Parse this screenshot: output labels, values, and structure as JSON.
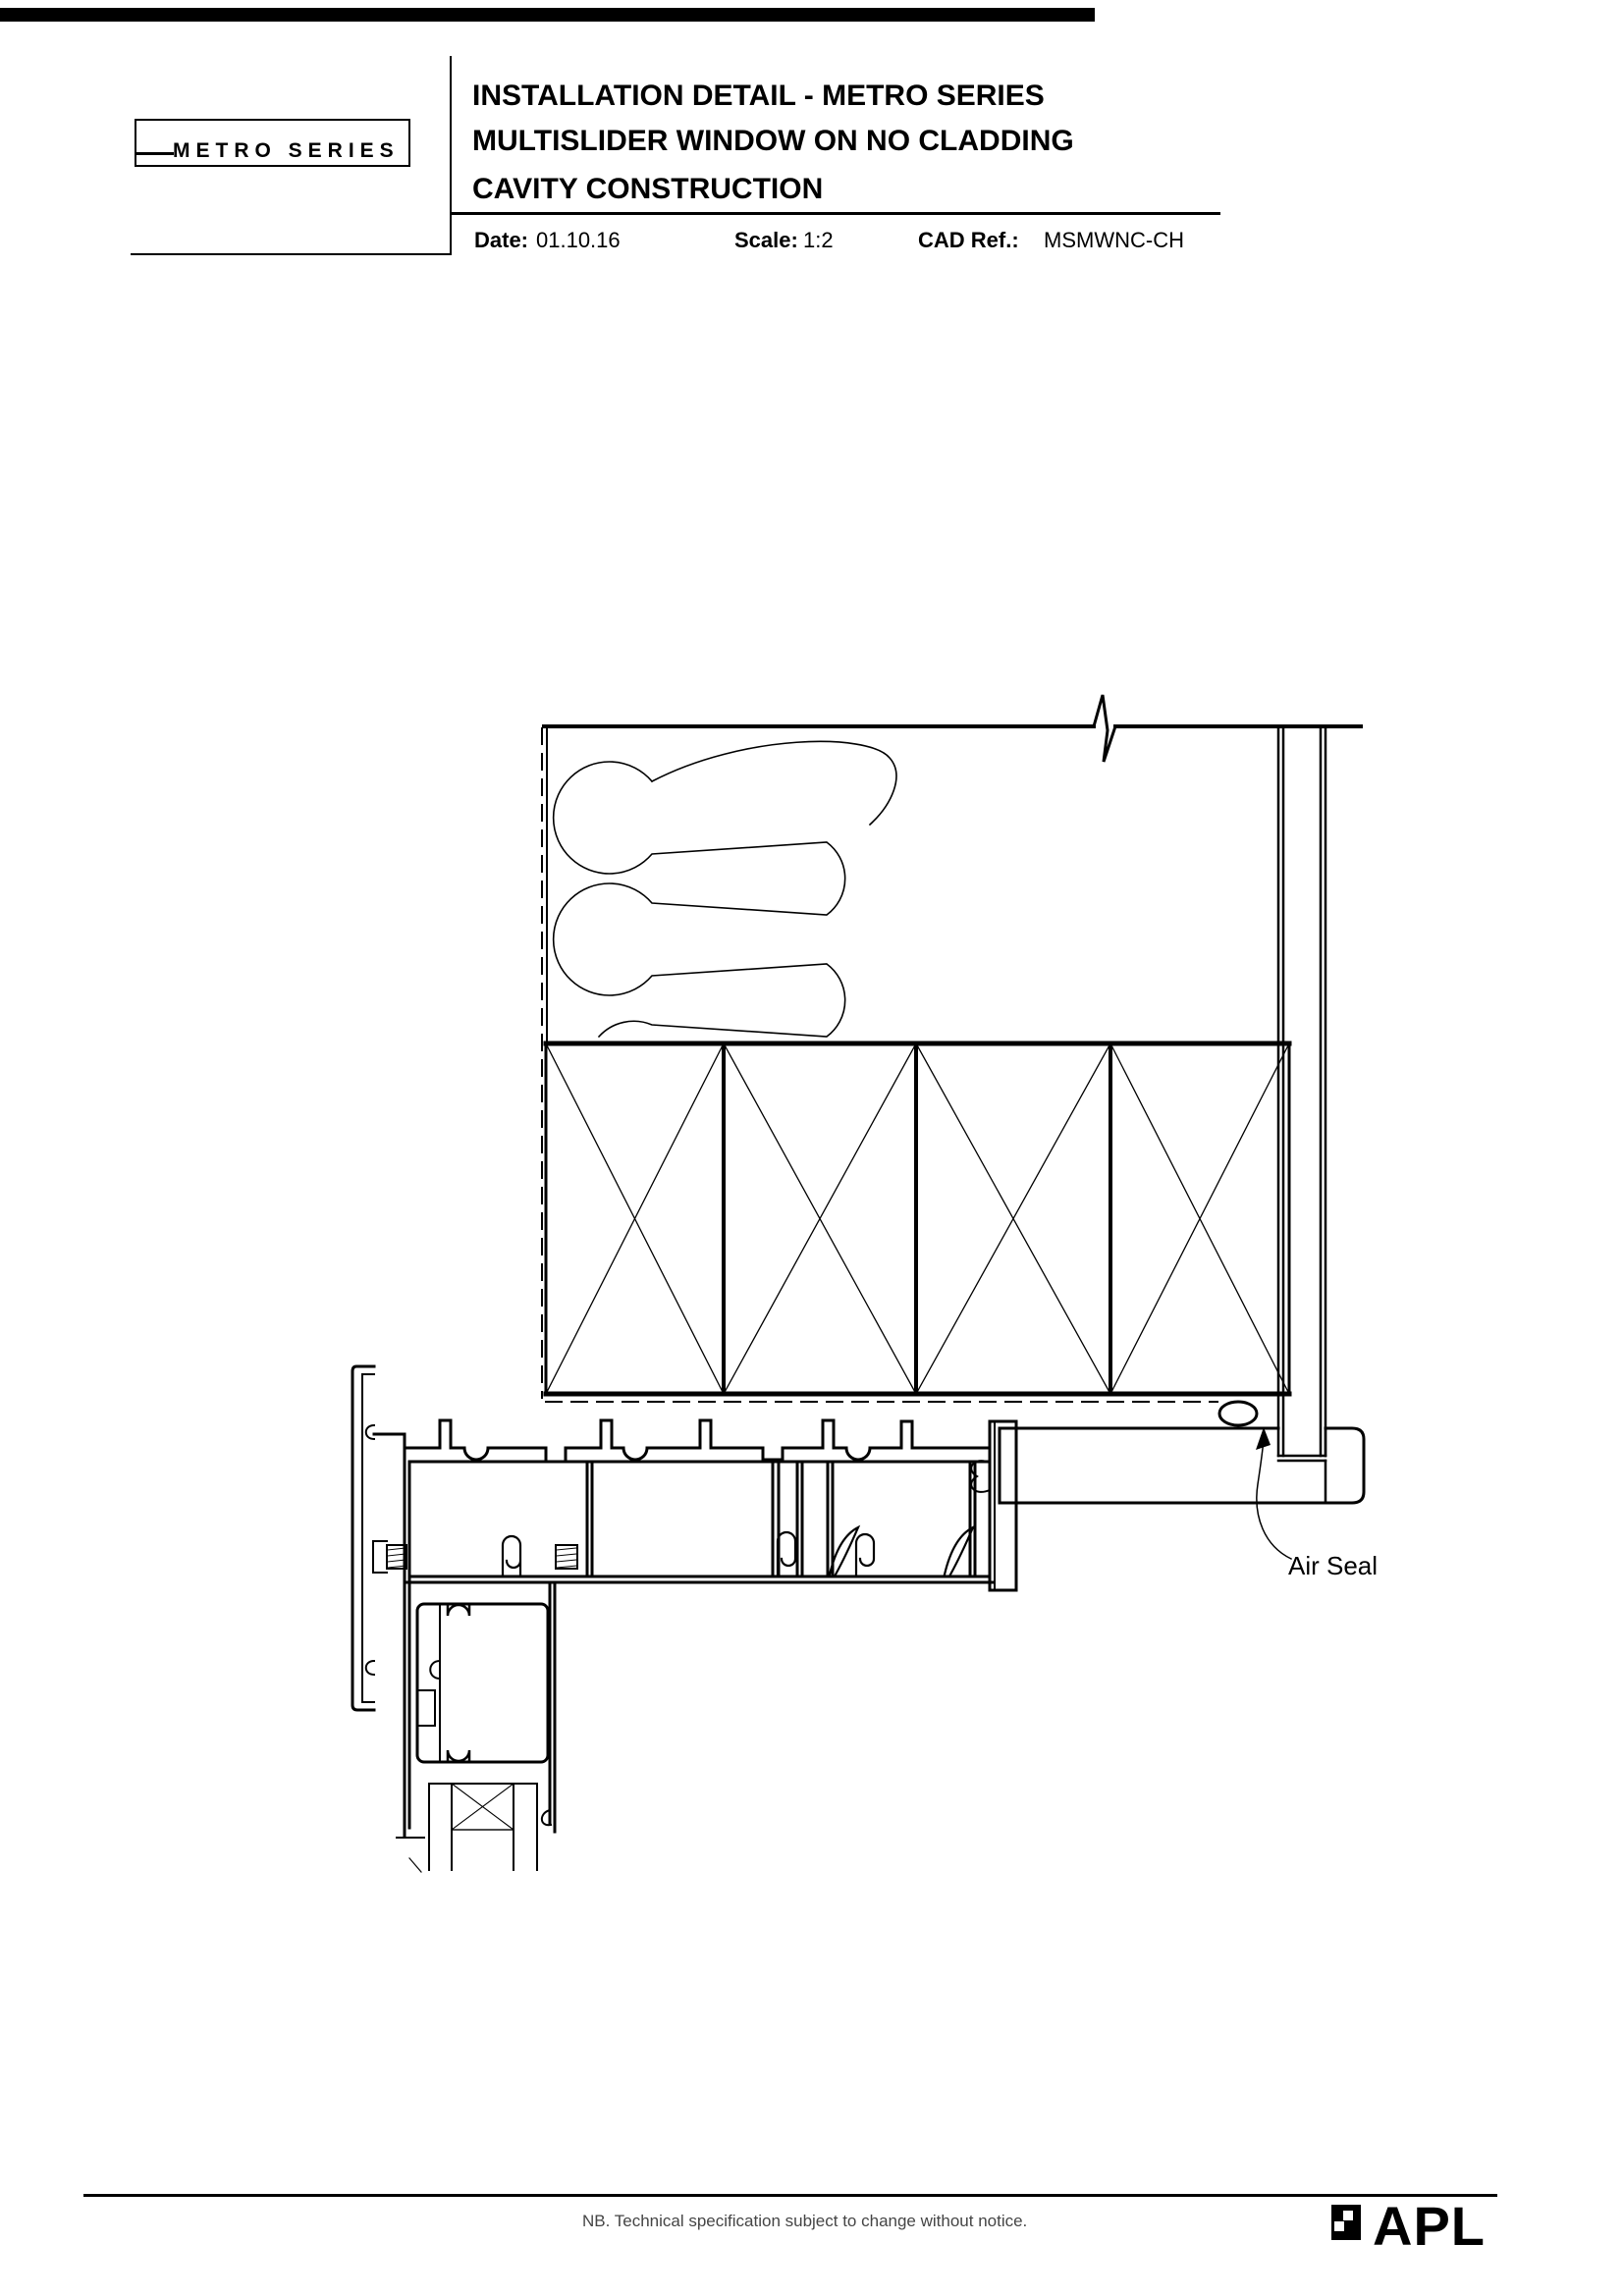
{
  "header": {
    "logo_text": "METRO SERIES",
    "title_lines": [
      "INSTALLATION DETAIL - METRO SERIES",
      "MULTISLIDER WINDOW ON NO CLADDING",
      "CAVITY CONSTRUCTION"
    ],
    "meta": {
      "date_label": "Date:",
      "date_value": "01.10.16",
      "scale_label": "Scale:",
      "scale_value": "1:2",
      "cad_ref_label": "CAD Ref.:",
      "cad_ref_value": "MSMWNC-CH"
    }
  },
  "drawing": {
    "annotations": {
      "air_seal": "Air Seal"
    }
  },
  "footer": {
    "note": "NB. Technical specification subject to change without notice.",
    "brand_text": "APL"
  },
  "colors": {
    "page_bg": "#ffffff",
    "ink": "#000000",
    "note_ink": "#454545"
  }
}
